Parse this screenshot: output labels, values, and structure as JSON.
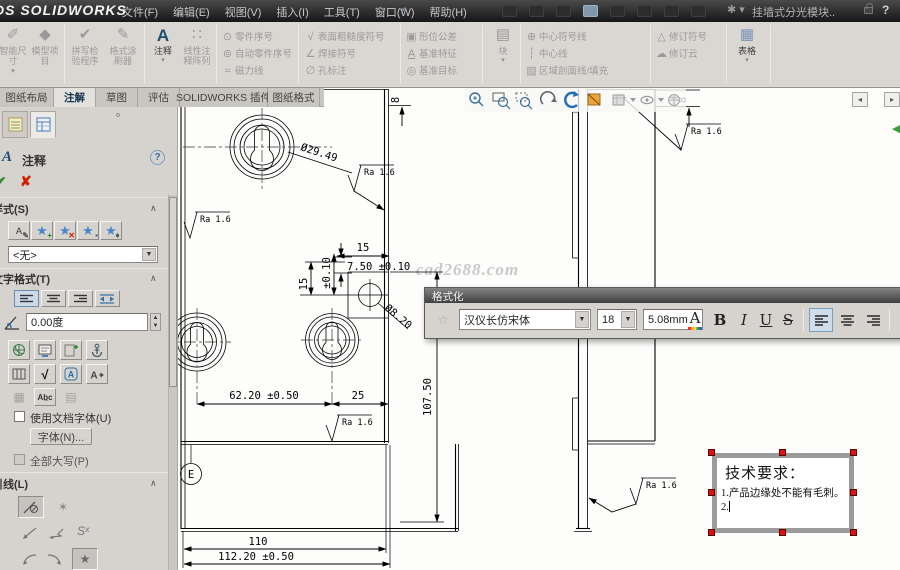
{
  "titlebar": {
    "logo": "DS SOLIDWORKS",
    "menus": [
      "文件(F)",
      "编辑(E)",
      "视图(V)",
      "插入(I)",
      "工具(T)",
      "窗口(W)",
      "帮助(H)"
    ],
    "doc_title": "挂墙式分光模块..",
    "help_label": "?"
  },
  "ribbon": {
    "smart_dimension": "智能尺寸",
    "model_items": "模型项目",
    "spell_checker": "拼写检验程序",
    "format_painter": "格式涂刷器",
    "note": "注释",
    "linear_note_pattern": "线性注释阵列",
    "balloon": "零件序号",
    "auto_balloon": "自动零件序号",
    "magnetic_line": "磁力线",
    "surface_finish": "表面粗糙度符号",
    "weld_symbol": "焊接符号",
    "hole_callout": "孔标注",
    "geometric_tolerance": "形位公差",
    "datum_feature": "基准特征",
    "datum_target": "基准目标",
    "block": "块",
    "center_mark": "中心符号线",
    "centerline": "中心线",
    "area_hatch": "区域剖面线/填充",
    "revision_symbol": "修订符号",
    "revision_cloud": "修订云",
    "tables": "表格"
  },
  "tabs": [
    {
      "label": "图纸布局"
    },
    {
      "label": "注解"
    },
    {
      "label": "草图"
    },
    {
      "label": "评估"
    },
    {
      "label": "SOLIDWORKS 插件"
    },
    {
      "label": "图纸格式"
    }
  ],
  "panel": {
    "title": "注释",
    "help": "?",
    "style_section": "样式(S)",
    "style_value": "<无>",
    "text_format_section": "文字格式(T)",
    "angle_value": "0.00度",
    "use_document_font": "使用文档字体(U)",
    "font_button": "字体(N)...",
    "all_caps": "全部大写(P)",
    "leader_section": "引线(L)",
    "spline_leader": "Sˣ"
  },
  "format_toolbar": {
    "title": "格式化",
    "font_name": "汉仪长仿宋体",
    "font_size": "18",
    "text_height": "5.08mm",
    "color": "A",
    "bold": "B",
    "italic": "I",
    "underline": "U",
    "strike": "S"
  },
  "drawing": {
    "dims": {
      "dia_big": "Ø29.49",
      "dia_small": "Ø8.20",
      "len15": "15",
      "len750": "7.50 ±0.10",
      "v15": "15",
      "vtol": "±0.10",
      "len6220": "62.20 ±0.50",
      "len25": "25",
      "len110": "110",
      "len11220": "112.20 ±0.50",
      "height10750": "107.50",
      "t8_front": "8",
      "t8_side": "8"
    },
    "surface_finish": "Ra 1.6",
    "datum_label": "E"
  },
  "tech_note": {
    "line1": "技术要求：",
    "line2": "1.产品边缘处不能有毛刺。",
    "line3": "2."
  },
  "watermark": "cad2688.com",
  "colors": {
    "accent_blue": "#2f6fa8",
    "handle_red": "#dd1111",
    "enabled_icon": "#1d4f76"
  }
}
